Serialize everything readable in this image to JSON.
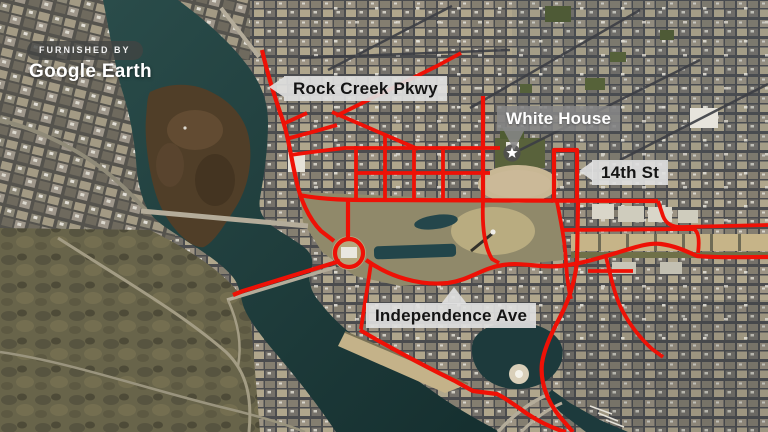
{
  "attribution": {
    "badge_label": "FURNISHED BY",
    "source_name": "Google Earth"
  },
  "map_labels": {
    "rock_creek_pkwy": {
      "text": "Rock Creek Pkwy",
      "style": "light",
      "pointer": "left"
    },
    "white_house": {
      "text": "White House",
      "style": "dark",
      "pointer": "down"
    },
    "fourteenth_st": {
      "text": "14th St",
      "style": "light",
      "pointer": "left"
    },
    "independence_ave": {
      "text": "Independence Ave",
      "style": "light",
      "pointer": "up"
    }
  },
  "marker": {
    "name": "white-house-location",
    "icon": "star-icon"
  },
  "colors": {
    "highlight_red": "#ee1106",
    "water_teal": "#1e3c3b",
    "label_light_bg": "#dfdfdf",
    "label_dark_bg": "#868686",
    "badge_bg": "#424442"
  }
}
